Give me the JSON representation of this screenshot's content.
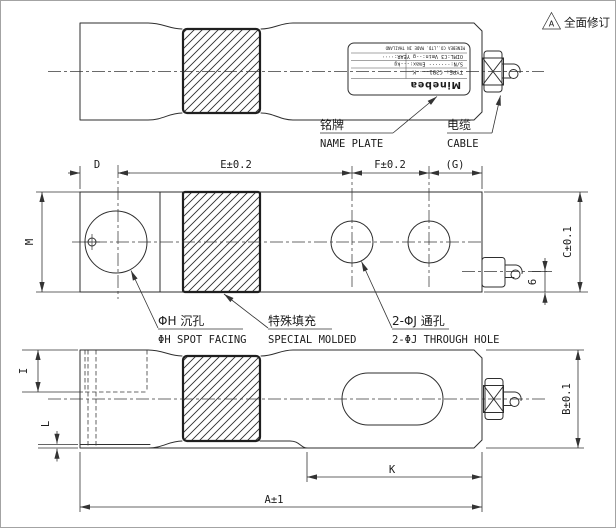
{
  "revision": {
    "marker_letter": "A",
    "note": "全面修订"
  },
  "top_view": {
    "name_plate": {
      "logo": "Minebea",
      "type_row": "TYPE:  C3B1----K",
      "sn_row": "S/N:·······  Emax:---kg",
      "detail_row": "OIML:C3  Vmin:--g  YEAR:····",
      "maker_row": "MINEBEA CO.,LTD.  MADE IN THAILAND"
    },
    "labels": {
      "name_plate_zh": "铭牌",
      "name_plate_en": "NAME PLATE",
      "cable_zh": "电缆",
      "cable_en": "CABLE"
    }
  },
  "front_view": {
    "dims": {
      "d": "D",
      "e": "E±0.2",
      "f": "F±0.2",
      "g": "(G)",
      "m": "M",
      "c": "C±0.1",
      "cable_offset": "6"
    },
    "labels": {
      "spot_facing_zh": "ΦH 沉孔",
      "spot_facing_en": "ΦH SPOT FACING",
      "special_molded_zh": "特殊填充",
      "special_molded_en": "SPECIAL MOLDED",
      "through_hole_zh": "2-ΦJ 通孔",
      "through_hole_en": "2-ΦJ THROUGH HOLE"
    }
  },
  "bottom_view": {
    "dims": {
      "i": "I",
      "l": "L",
      "k": "K",
      "a": "A±1",
      "b": "B±0.1"
    }
  }
}
